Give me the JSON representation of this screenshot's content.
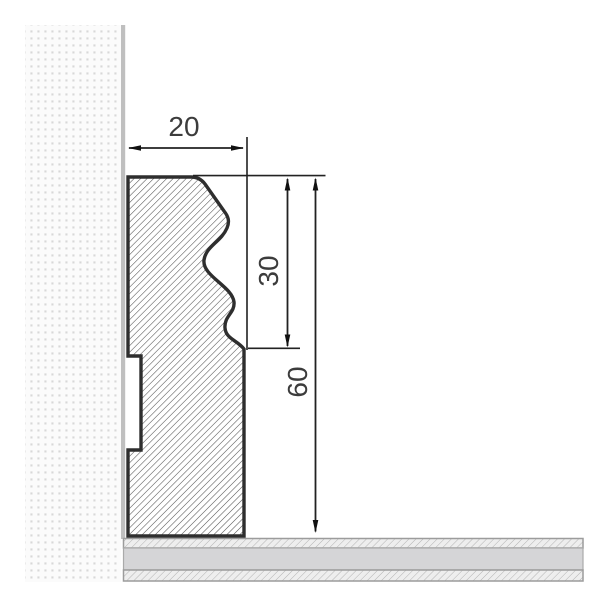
{
  "drawing": {
    "title": "Skirting board cross-section technical drawing",
    "units_shown": false,
    "labels": {
      "width": "20",
      "upper_height": "30",
      "total_height": "60"
    },
    "dimensions": [
      {
        "name": "profile-width",
        "value": 20,
        "orientation": "horizontal"
      },
      {
        "name": "ogee-section-height",
        "value": 30,
        "orientation": "vertical"
      },
      {
        "name": "total-profile-height",
        "value": 60,
        "orientation": "vertical"
      }
    ],
    "elements": {
      "wall": "dotted plaster texture with gray surface line",
      "skirting_profile": "ogee (S-curve) top, flat face, rear cable groove, diagonal hatch fill",
      "floor": "three layers: thin hatched top, solid core, thin hatched bottom"
    },
    "colors": {
      "background": "#ffffff",
      "wall_dot": "#d8d8d8",
      "wall_surface": "#bfbfbf",
      "profile_outline": "#2e2e2e",
      "profile_hatch": "#4a4a4a",
      "floor_core": "#d5d5d7",
      "floor_border": "#9c9c9c",
      "dimension_line": "#222222",
      "text": "#3c3c3c"
    }
  }
}
